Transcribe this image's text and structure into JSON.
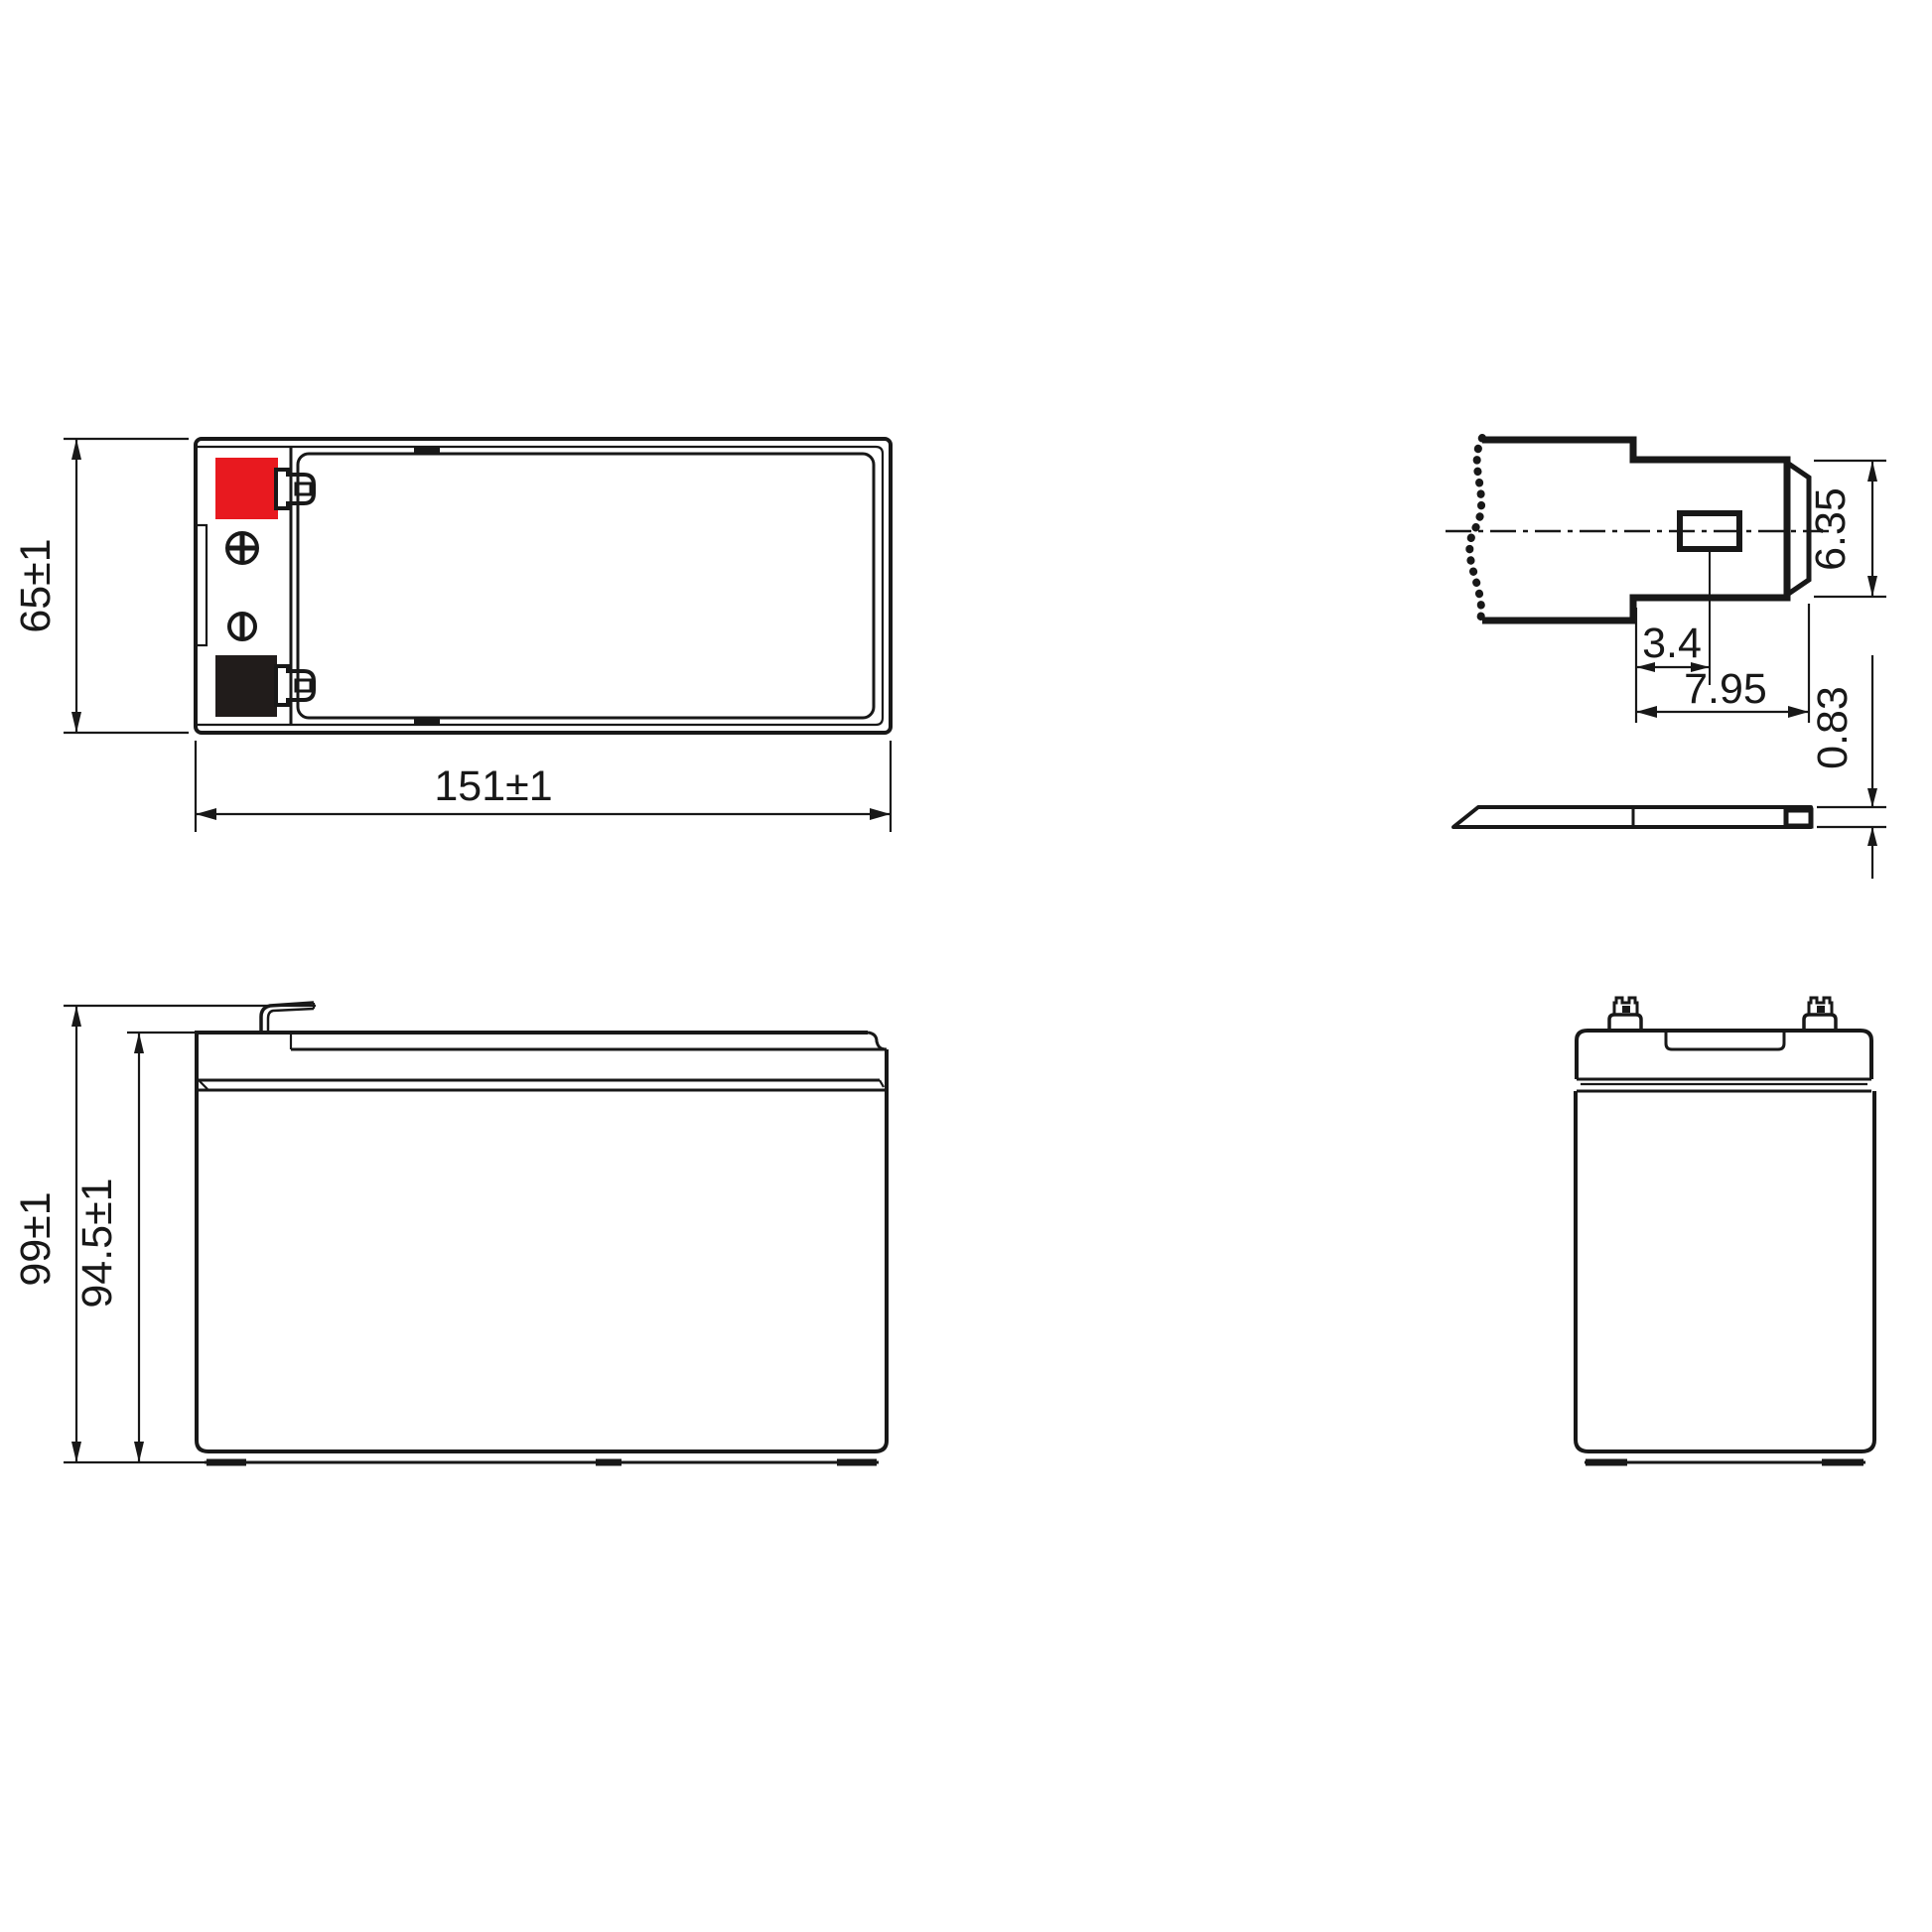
{
  "drawing": {
    "title": "battery-dimensional-drawing",
    "line_color": "#181818",
    "background_color": "#ffffff",
    "views": {
      "top_view": {
        "name": "top view",
        "width_dim": "151±1",
        "height_dim": "65±1",
        "positive_color": "#e8191f",
        "negative_color": "#211c1b"
      },
      "terminal_detail": {
        "name": "terminal detail",
        "tab_width_dim": "6.35",
        "hole_center_dim": "3.4",
        "tab_length_dim": "7.95",
        "tab_thickness_dim": "0.83"
      },
      "side_view": {
        "name": "side view",
        "overall_height_dim": "99±1",
        "case_height_dim": "94.5±1"
      },
      "end_view": {
        "name": "end view"
      }
    }
  }
}
